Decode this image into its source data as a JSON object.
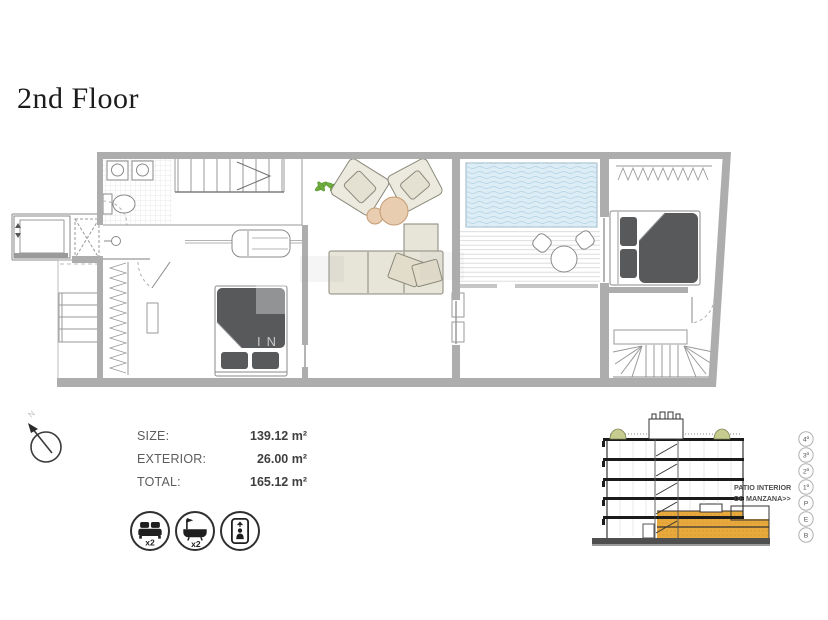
{
  "title": "2nd Floor",
  "watermark": "IN",
  "info": {
    "rows": [
      {
        "label": "SIZE:",
        "value": "139.12 m²"
      },
      {
        "label": "EXTERIOR:",
        "value": "26.00 m²"
      },
      {
        "label": "TOTAL:",
        "value": "165.12 m²"
      }
    ]
  },
  "features": {
    "bed": {
      "icon": "bed-icon",
      "count": "x2"
    },
    "bath": {
      "icon": "bath-icon",
      "count": "x2"
    },
    "elevator": {
      "icon": "elevator-icon",
      "count": ""
    }
  },
  "section": {
    "caption_line1": "PATIO INTERIOR",
    "caption_line2": "DE MANZANA>>",
    "floor_labels": [
      "4º",
      "3º",
      "2º",
      "1º",
      "P",
      "E",
      "B"
    ]
  },
  "colors": {
    "wall_gray": "#ADADAD",
    "bed_dark": "#58595B",
    "sofa_beige": "#E7E4D8",
    "table_tan": "#E9CDB0",
    "pool_blue": "#DDEDF6",
    "plant_green": "#6FAE3E",
    "section_highlight_orange": "#E8A93C",
    "section_bush_green": "#C6CB8F"
  }
}
